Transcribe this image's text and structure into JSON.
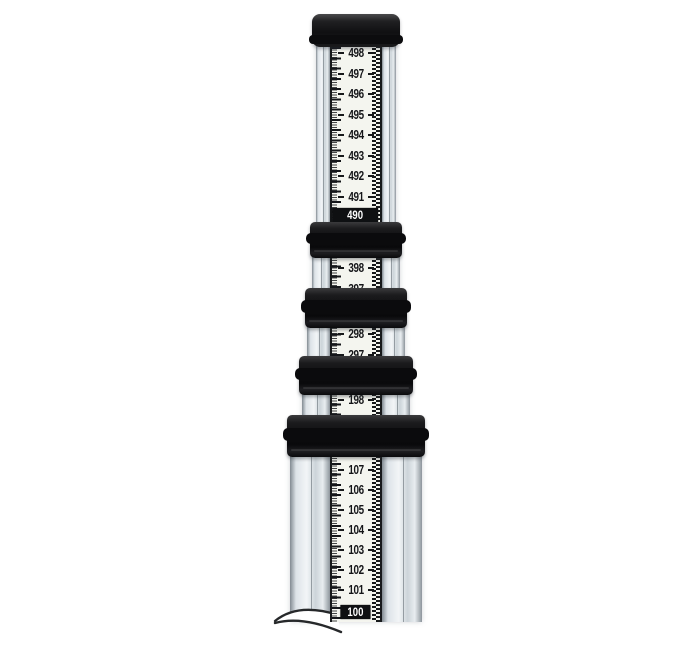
{
  "meta": {
    "subject": "Collapsed telescoping leveling rod (grade rod), product photo on white background",
    "background_color": "#ffffff"
  },
  "rod": {
    "cap": {
      "name": "top-cap"
    },
    "collar_count": 4,
    "colors": {
      "hardware_black": "#111113",
      "rail_silver": "#d6dde2",
      "scale_face": "#f4f5ef",
      "marking_black": "#17191b",
      "inverted_text": "#ffffff"
    },
    "sections": [
      {
        "id": "section-400s",
        "numbers": [
          "498",
          "497",
          "496",
          "495",
          "494",
          "493",
          "492",
          "491"
        ],
        "inverted_number": "490"
      },
      {
        "id": "section-300s",
        "numbers": [
          "398",
          "397"
        ]
      },
      {
        "id": "section-200s",
        "numbers": [
          "298",
          "297"
        ]
      },
      {
        "id": "section-190s",
        "numbers": [
          "198"
        ]
      },
      {
        "id": "section-100s",
        "numbers": [
          "107",
          "106",
          "105",
          "104",
          "103",
          "102",
          "101"
        ],
        "inverted_number": "100"
      }
    ]
  }
}
